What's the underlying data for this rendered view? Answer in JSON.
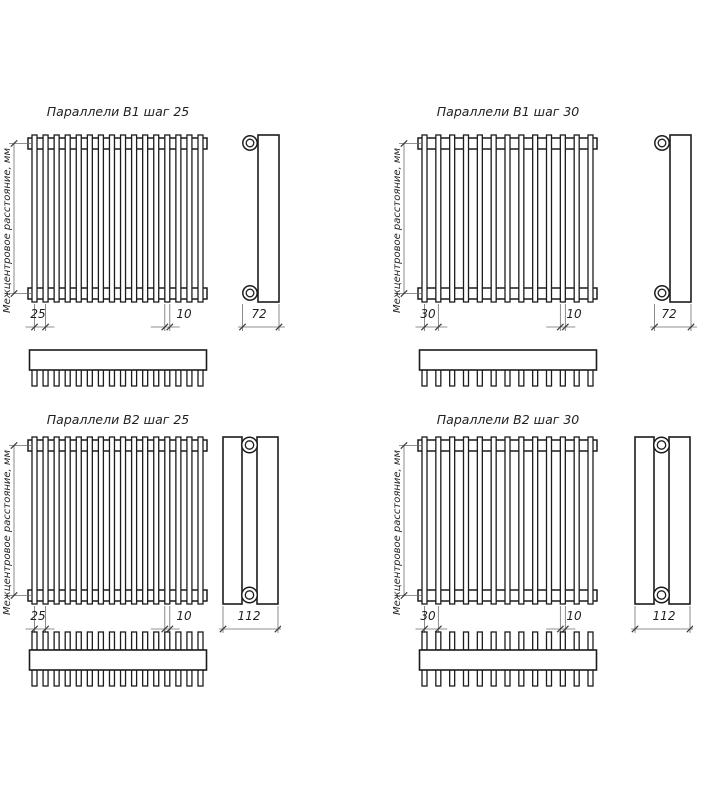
{
  "drawing": {
    "axis_label": "Межцентровое расстояние, мм",
    "colors": {
      "background": "#ffffff",
      "outline": "#1c1c1c",
      "dimension": "#6e6e6e",
      "tick": "#3a3a3a",
      "text": "#1f1f1f"
    },
    "panels": [
      {
        "title": "Параллели В1 шаг 25",
        "pitch": "25",
        "tube_width": "10",
        "depth": "72",
        "tube_count": 16,
        "rows": 1
      },
      {
        "title": "Параллели В1 шаг 30",
        "pitch": "30",
        "tube_width": "10",
        "depth": "72",
        "tube_count": 13,
        "rows": 1
      },
      {
        "title": "Параллели В2 шаг 25",
        "pitch": "25",
        "tube_width": "10",
        "depth": "112",
        "tube_count": 16,
        "rows": 2
      },
      {
        "title": "Параллели В2 шаг 30",
        "pitch": "30",
        "tube_width": "10",
        "depth": "112",
        "tube_count": 13,
        "rows": 2
      }
    ]
  }
}
